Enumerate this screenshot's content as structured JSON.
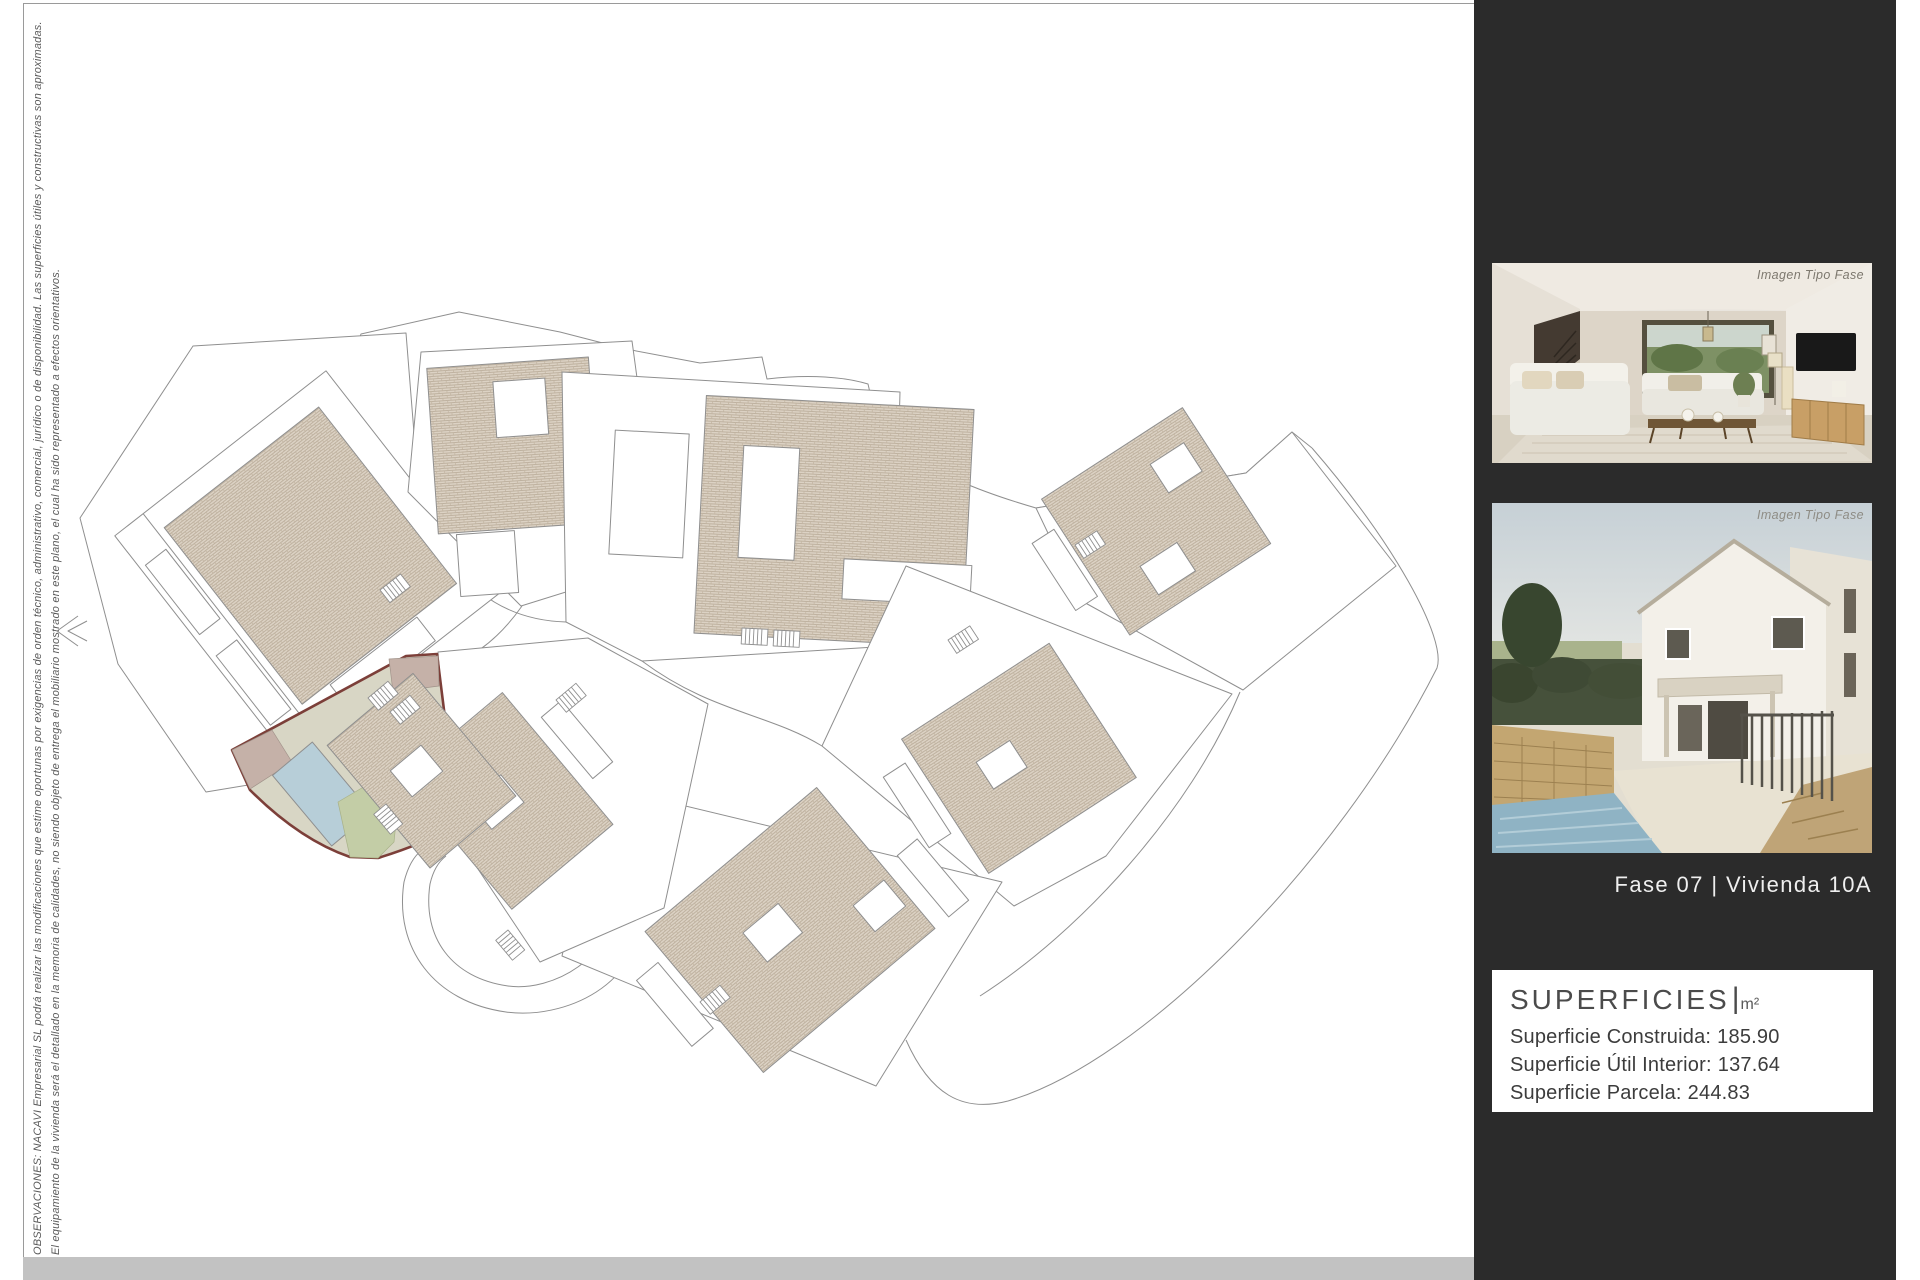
{
  "page": {
    "disclaimer_line1": "OBSERVACIONES: NACAVI Empresarial SL podrá realizar las modificaciones que estime oportunas por exigencias de orden técnico, administrativo, comercial, jurídico o de disponibilidad. Las superficies útiles y constructivas son aproximadas.",
    "disclaimer_line2": "El equipamiento de la vivienda será el detallado en la memoria de calidades, no siendo objeto de entrega el mobiliario mostrado en este plano, el cual ha sido representado a efectos orientativos."
  },
  "sidebar": {
    "photo1_caption": "Imagen Tipo Fase",
    "photo2_caption": "Imagen Tipo Fase",
    "unit_label": "Fase 07 |  Vivienda 10A",
    "superficies": {
      "title": "SUPERFICIES",
      "title_separator": "|",
      "title_unit": "m²",
      "rows": [
        {
          "label": "Superficie Construida:",
          "value": "185.90"
        },
        {
          "label": "Superficie Útil Interior:",
          "value": "137.64"
        },
        {
          "label": "Superficie Parcela:",
          "value": "244.83"
        }
      ]
    }
  },
  "colors": {
    "sidebar-bg": "#2b2b2b",
    "panel-bg": "#ffffff",
    "bottom-bar": "#c2c2c2",
    "accent": "#7c3f39",
    "plot-fill": "#d8d6c5",
    "pool-blue": "#b7ced8",
    "garden-green": "#c3cda6",
    "terrace-mauve": "#c5b1a8",
    "roof-tan": "#dcd2c4",
    "line-gray": "#8f8f8f"
  }
}
